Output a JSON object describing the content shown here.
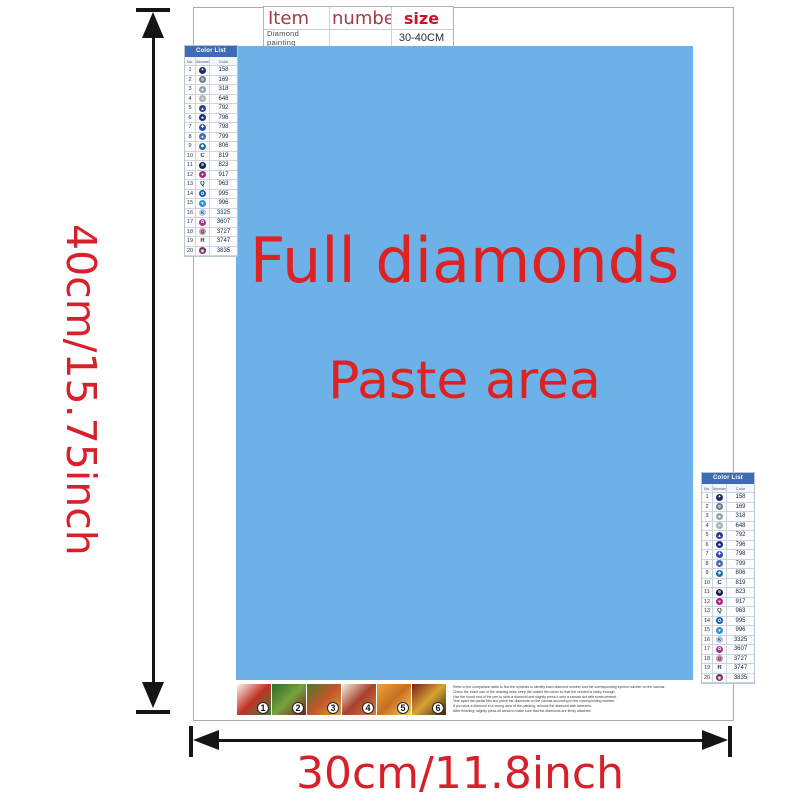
{
  "top_table": {
    "headers": [
      "Item",
      "number",
      "size"
    ],
    "row": [
      "Diamond painting",
      "",
      "30-40CM"
    ]
  },
  "paste_area": {
    "line1": "Full diamonds",
    "line2": "Paste area"
  },
  "dimensions": {
    "height_label": "40cm/15.75inch",
    "width_label": "30cm/11.8inch"
  },
  "colors": {
    "paste_bg": "#6cb2e8",
    "red_text": "#de2121",
    "dimension_red": "#d6212b",
    "table_header_red": "#a23b46",
    "size_red": "#cb1628",
    "color_list_header_bg": "#3e6cb4",
    "arrow_black": "#151515"
  },
  "color_list": {
    "title": "Color List",
    "columns": [
      "No.",
      "Diamond",
      "Color"
    ],
    "rows": [
      {
        "no": "1",
        "code": "158",
        "style": "circle",
        "color": "#232a6a",
        "glyph": "✦"
      },
      {
        "no": "2",
        "code": "169",
        "style": "circle",
        "color": "#6e7b88",
        "glyph": "Φ"
      },
      {
        "no": "3",
        "code": "318",
        "style": "circle",
        "color": "#93a0ac",
        "glyph": "♣"
      },
      {
        "no": "4",
        "code": "648",
        "style": "circle",
        "color": "#aab4ae",
        "glyph": "✳"
      },
      {
        "no": "5",
        "code": "792",
        "style": "circle",
        "color": "#2c3e92",
        "glyph": "▲"
      },
      {
        "no": "6",
        "code": "796",
        "style": "circle",
        "color": "#1c2c80",
        "glyph": "★"
      },
      {
        "no": "7",
        "code": "798",
        "style": "circle",
        "color": "#2c4caa",
        "glyph": "✚"
      },
      {
        "no": "8",
        "code": "799",
        "style": "circle",
        "color": "#4769bc",
        "glyph": "♠"
      },
      {
        "no": "9",
        "code": "806",
        "style": "circle",
        "color": "#1a6fa0",
        "glyph": "◆"
      },
      {
        "no": "10",
        "code": "819",
        "style": "letter",
        "color": "",
        "glyph": "C"
      },
      {
        "no": "11",
        "code": "823",
        "style": "circle",
        "color": "#171f52",
        "glyph": "⊕"
      },
      {
        "no": "12",
        "code": "917",
        "style": "circle",
        "color": "#aa2088",
        "glyph": "♥"
      },
      {
        "no": "13",
        "code": "963",
        "style": "letter",
        "color": "",
        "glyph": "Q"
      },
      {
        "no": "14",
        "code": "995",
        "style": "circle",
        "color": "#0f57aa",
        "glyph": "✪"
      },
      {
        "no": "15",
        "code": "996",
        "style": "circle",
        "color": "#2f90d8",
        "glyph": "▼"
      },
      {
        "no": "16",
        "code": "3325",
        "style": "letter-circle",
        "color": "#a9c9ea",
        "glyph": "K"
      },
      {
        "no": "17",
        "code": "3607",
        "style": "circle",
        "color": "#b12c90",
        "glyph": "✿"
      },
      {
        "no": "18",
        "code": "3727",
        "style": "letter-circle",
        "color": "#c795ad",
        "glyph": "Q"
      },
      {
        "no": "19",
        "code": "3747",
        "style": "letter",
        "color": "",
        "glyph": "R"
      },
      {
        "no": "20",
        "code": "3835",
        "style": "circle",
        "color": "#7c2a70",
        "glyph": "◉"
      }
    ]
  },
  "steps": {
    "tiles": [
      {
        "num": "1",
        "colors": [
          "#f7f5ee",
          "#c23226",
          "#3f7f3a"
        ]
      },
      {
        "num": "2",
        "colors": [
          "#2e6b2c",
          "#77a23c",
          "#7a1f1f"
        ]
      },
      {
        "num": "3",
        "colors": [
          "#4c7a2e",
          "#c2542a",
          "#d8a13c"
        ]
      },
      {
        "num": "4",
        "colors": [
          "#f2efe6",
          "#a8402c",
          "#d87f35"
        ]
      },
      {
        "num": "5",
        "colors": [
          "#e8a53c",
          "#c96f22",
          "#f4d06a"
        ]
      },
      {
        "num": "6",
        "colors": [
          "#7a1e16",
          "#d8a435",
          "#3a2210"
        ]
      }
    ]
  },
  "instructions": {
    "lines": [
      "Refer to the comparison table to find the symbols to identify each diamond number and the corresponding symbol number on the canvas.",
      "Check the exact size of the drawing area; keep the coated film clean so that the cement is sticky enough.",
      "Use the round end of the pen to stick a diamond and slightly press it onto a canvas dot with some cement.",
      "Tear apart the partial film and place the diamonds on the canvas according to the corresponding number.",
      "If you stick a diamond in a wrong area of the painting, remove the diamond with tweezers.",
      "After finishing, slightly press all areas to make sure that the diamonds are firmly attached."
    ]
  }
}
